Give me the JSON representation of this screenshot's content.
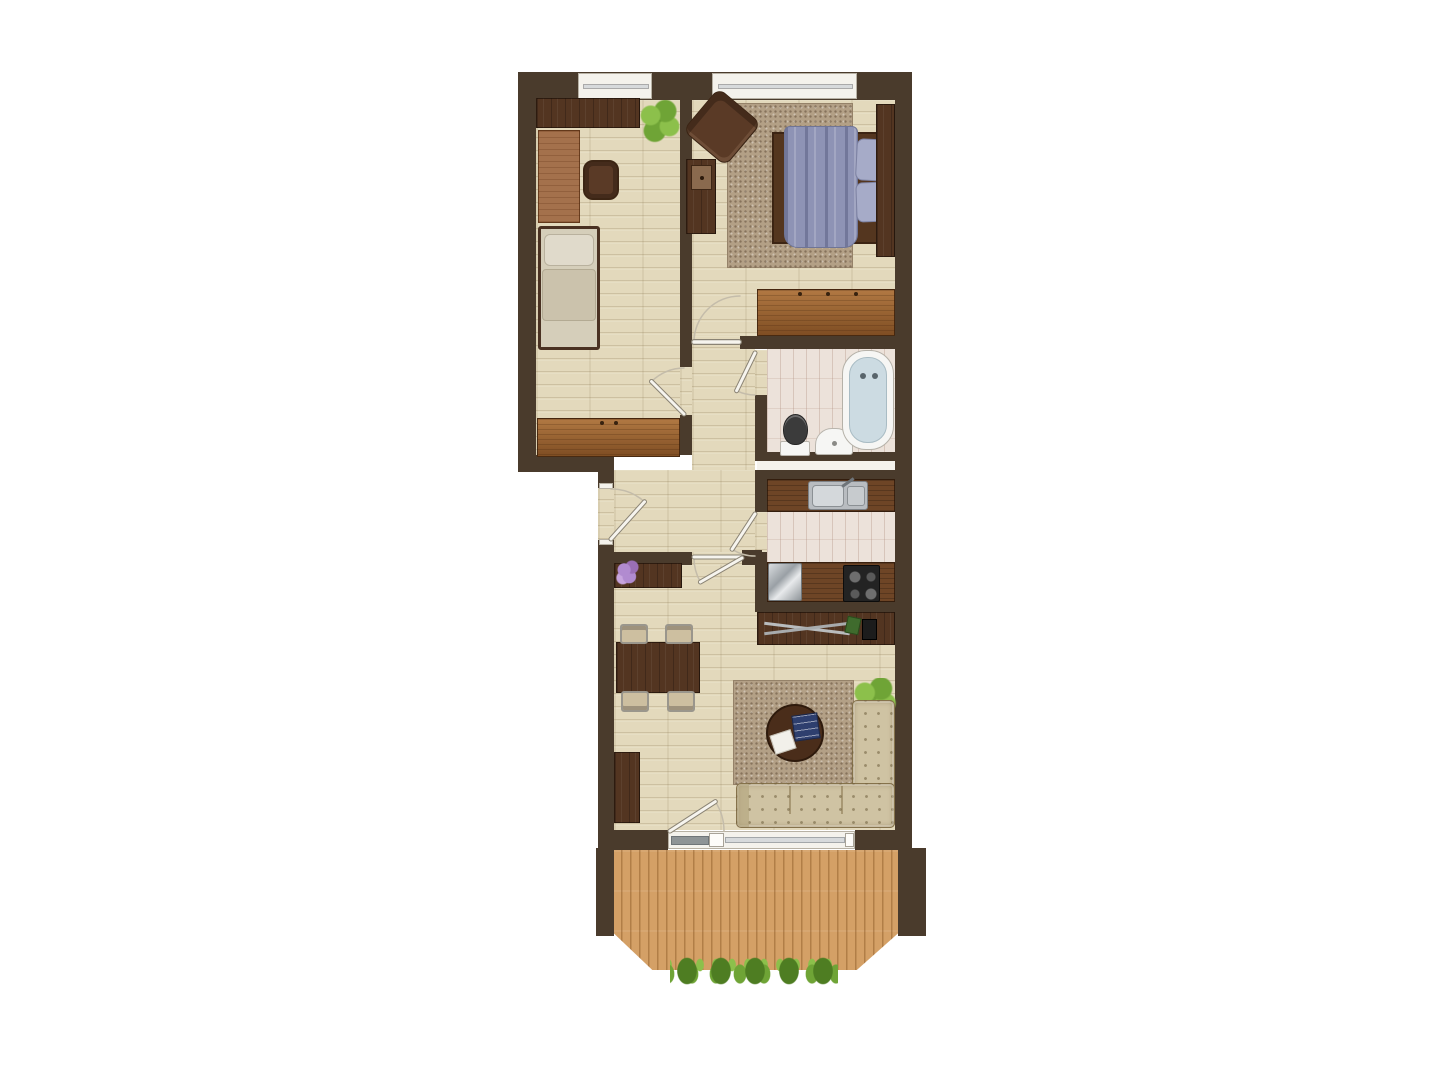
{
  "plan": {
    "type": "apartment-floor-plan",
    "rooms": [
      {
        "id": "office",
        "label": "office-kids-room",
        "furniture": [
          "wall-shelf",
          "potted-plant",
          "desk",
          "office-chair",
          "single-bed",
          "wardrobe"
        ]
      },
      {
        "id": "bedroom",
        "label": "bedroom",
        "furniture": [
          "armchair",
          "dresser",
          "double-bed",
          "rug",
          "headboard-closet",
          "wardrobe"
        ]
      },
      {
        "id": "bathroom",
        "label": "bathroom",
        "furniture": [
          "toilet",
          "washbasin",
          "bathtub"
        ]
      },
      {
        "id": "kitchen",
        "label": "kitchen",
        "furniture": [
          "sink-countertop",
          "refrigerator",
          "countertop",
          "cooktop"
        ]
      },
      {
        "id": "hallway",
        "label": "entrance-hall",
        "furniture": [
          "sideboard",
          "flower-bouquet"
        ]
      },
      {
        "id": "living",
        "label": "living-room",
        "furniture": [
          "dining-table",
          "dining-chairs-x4",
          "cabinet",
          "media-console",
          "rug",
          "round-coffee-table",
          "books",
          "corner-sofa",
          "potted-plant"
        ]
      },
      {
        "id": "balcony",
        "label": "balcony",
        "furniture": [
          "wood-deck",
          "planter-row"
        ]
      }
    ],
    "doors": [
      "entrance-door",
      "office-door",
      "bedroom-door",
      "bathroom-door",
      "kitchen-door",
      "living-room-door",
      "balcony-door"
    ],
    "windows": [
      "office-window",
      "bedroom-window",
      "balcony-glazing"
    ]
  },
  "colors": {
    "background": "#ffffff",
    "wall": "#4a3b2c",
    "floor": "#e3d9bc",
    "rug": "#b3a086",
    "walnut": "#533521",
    "wardrobe": "#9b5f2b",
    "desk": "#a4714c",
    "counter": "#6e4526",
    "tile": "#ece2da",
    "deck": "#d4a066",
    "sofa": "#cfc3a3",
    "seat": "#cdbfa0",
    "mattress": "#d5ceba",
    "pillow": "#e0dacb",
    "duvet": "#8e93b5",
    "duvet_pillow": "#a6abc8",
    "plant": "#6fa436",
    "plant_light": "#8cc04b",
    "plant_dark": "#4e7d22",
    "flowers": "#b18bd0",
    "steel": "#b8bcc0",
    "cooktop": "#232323",
    "fixture": "#f6f6f4",
    "tub_inner": "#ccdbe2",
    "door_leaf": "#f6f4ee",
    "door_arc": "#c4bcaa",
    "glass": "#d7dadc"
  }
}
